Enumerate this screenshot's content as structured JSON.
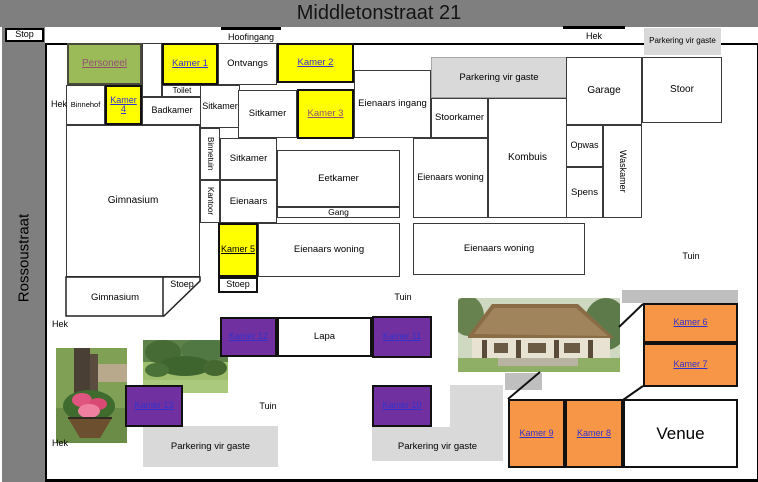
{
  "title": "Middletonstraat 21",
  "streets": {
    "left_street": "Rossoustraat",
    "stop_sign": "Stop"
  },
  "gates": {
    "main_entrance": "Hoofingang",
    "gate": "Hek"
  },
  "areas": {
    "parking": "Parkering vir gaste",
    "garden": "Tuin"
  },
  "rooms": {
    "personeel": "Personeel",
    "kamer1": "Kamer 1",
    "kamer2": "Kamer 2",
    "kamer3": "Kamer 3",
    "kamer4": "Kamer 4",
    "kamer5": "Kamer 5",
    "kamer6": "Kamer 6",
    "kamer7": "Kamer 7",
    "kamer8": "Kamer 8",
    "kamer9": "Kamer 9",
    "kamer10": "Kamer 10",
    "kamer11": "Kamer 11",
    "kamer12": "Kamer 12",
    "kamer13": "Kamer 13",
    "ontvangs": "Ontvangs",
    "toilet": "Toilet",
    "badkamer": "Badkamer",
    "binnehof": "Binnehof",
    "sitkamer": "Sitkamer",
    "eienaars_ingang": "Eienaars ingang",
    "stoorkamer": "Stoorkamer",
    "kombuis": "Kombuis",
    "eetkamer": "Eetkamer",
    "gang": "Gang",
    "eienaars": "Eienaars",
    "eienaars_woning": "Eienaars woning",
    "binnetuin": "Binnetuin",
    "kantoor": "Kantoor",
    "gimnasium": "Gimnasium",
    "stoep": "Stoep",
    "opwas": "Opwas",
    "spens": "Spens",
    "waskamer": "Waskamer",
    "garage": "Garage",
    "stoor": "Stoor",
    "lapa": "Lapa",
    "venue": "Venue"
  },
  "colors": {
    "room_yellow": "#FFFF00",
    "staff_green": "#9BBB59",
    "room_purple": "#7030A0",
    "room_orange": "#F79646",
    "parking_gray": "#D9D9D9",
    "street_gray": "#7F7F7F",
    "link_blue": "#3333CC",
    "visited_link": "#954F72"
  }
}
